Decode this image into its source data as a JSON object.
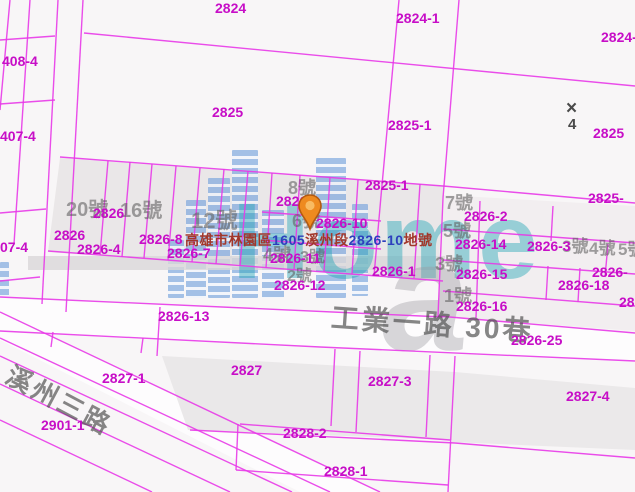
{
  "map": {
    "background": "#f8f6f7",
    "line_color": "#e83ae8",
    "parcel_label_color": "#c70ec7",
    "parcel_labels": [
      {
        "text": "2824",
        "x": 215,
        "y": 1
      },
      {
        "text": "2824-1",
        "x": 396,
        "y": 11
      },
      {
        "text": "2824-",
        "x": 601,
        "y": 30
      },
      {
        "text": "408-4",
        "x": 2,
        "y": 54
      },
      {
        "text": "407-4",
        "x": 0,
        "y": 129
      },
      {
        "text": "07-4",
        "x": 0,
        "y": 240
      },
      {
        "text": "2825",
        "x": 212,
        "y": 105
      },
      {
        "text": "2825-1",
        "x": 388,
        "y": 118
      },
      {
        "text": "2825",
        "x": 593,
        "y": 126
      },
      {
        "text": "2825-1",
        "x": 365,
        "y": 178
      },
      {
        "text": "2825-",
        "x": 588,
        "y": 191
      },
      {
        "text": "2826-9",
        "x": 276,
        "y": 194
      },
      {
        "text": "2826",
        "x": 93,
        "y": 206
      },
      {
        "text": "2826-10",
        "x": 316,
        "y": 216
      },
      {
        "text": "2826",
        "x": 54,
        "y": 228
      },
      {
        "text": "2826-8",
        "x": 139,
        "y": 232
      },
      {
        "text": "2826-4",
        "x": 77,
        "y": 242
      },
      {
        "text": "2826-7",
        "x": 167,
        "y": 246
      },
      {
        "text": "2826-11",
        "x": 270,
        "y": 251
      },
      {
        "text": "2826-12",
        "x": 274,
        "y": 278
      },
      {
        "text": "2826-13",
        "x": 158,
        "y": 309
      },
      {
        "text": "2826-1",
        "x": 372,
        "y": 264
      },
      {
        "text": "2826-2",
        "x": 464,
        "y": 209
      },
      {
        "text": "2826-3",
        "x": 527,
        "y": 239
      },
      {
        "text": "2826-14",
        "x": 455,
        "y": 237
      },
      {
        "text": "2826-15",
        "x": 456,
        "y": 267
      },
      {
        "text": "2826-16",
        "x": 456,
        "y": 299
      },
      {
        "text": "2826-18",
        "x": 558,
        "y": 278
      },
      {
        "text": "2826-",
        "x": 592,
        "y": 265
      },
      {
        "text": "28",
        "x": 619,
        "y": 295
      },
      {
        "text": "2826-25",
        "x": 511,
        "y": 333
      },
      {
        "text": "2827-1",
        "x": 102,
        "y": 371
      },
      {
        "text": "2827",
        "x": 231,
        "y": 363
      },
      {
        "text": "2827-3",
        "x": 368,
        "y": 374
      },
      {
        "text": "2827-4",
        "x": 566,
        "y": 389
      },
      {
        "text": "2828-2",
        "x": 283,
        "y": 426
      },
      {
        "text": "2828-1",
        "x": 324,
        "y": 464
      },
      {
        "text": "2901-1",
        "x": 41,
        "y": 418
      }
    ],
    "house_numbers": [
      {
        "text": "20號",
        "x": 66,
        "y": 200,
        "size": 20
      },
      {
        "text": "16號",
        "x": 120,
        "y": 201,
        "size": 20
      },
      {
        "text": "12號",
        "x": 191,
        "y": 209,
        "size": 22
      },
      {
        "text": "8號",
        "x": 288,
        "y": 179,
        "size": 18
      },
      {
        "text": "6號",
        "x": 292,
        "y": 212,
        "size": 18
      },
      {
        "text": "4號",
        "x": 263,
        "y": 246,
        "size": 18
      },
      {
        "text": "3號",
        "x": 300,
        "y": 250,
        "size": 16
      },
      {
        "text": "2號",
        "x": 287,
        "y": 269,
        "size": 16
      },
      {
        "text": "7號",
        "x": 445,
        "y": 194,
        "size": 18
      },
      {
        "text": "5號",
        "x": 443,
        "y": 222,
        "size": 18
      },
      {
        "text": "3號",
        "x": 435,
        "y": 255,
        "size": 18
      },
      {
        "text": "1號",
        "x": 444,
        "y": 287,
        "size": 18
      },
      {
        "text": "3號",
        "x": 562,
        "y": 238,
        "size": 17
      },
      {
        "text": "4號",
        "x": 589,
        "y": 240,
        "size": 17
      },
      {
        "text": "5號",
        "x": 618,
        "y": 241,
        "size": 17
      }
    ],
    "road_names": [
      {
        "text": "工業一路 30巷",
        "x": 332,
        "y": 303,
        "size": 28,
        "rot": 4
      },
      {
        "text": "溪州三路",
        "x": 14,
        "y": 362,
        "size": 26,
        "rot": 28
      }
    ],
    "marker": {
      "symbol": "×",
      "number": "4",
      "x": 566,
      "y": 100
    },
    "address": {
      "x": 185,
      "y": 230,
      "parts": [
        {
          "text": "高雄市林園區",
          "color": "#a2372b"
        },
        {
          "text": "1605",
          "color": "#2d3fbd"
        },
        {
          "text": "溪州段",
          "color": "#a2372b"
        },
        {
          "text": "2826-10",
          "color": "#2d3fbd"
        },
        {
          "text": "地號",
          "color": "#a2372b"
        }
      ]
    },
    "watermark": {
      "text": "Home",
      "tail_letter": "a"
    },
    "pin": {
      "x": 297,
      "y": 193
    }
  }
}
